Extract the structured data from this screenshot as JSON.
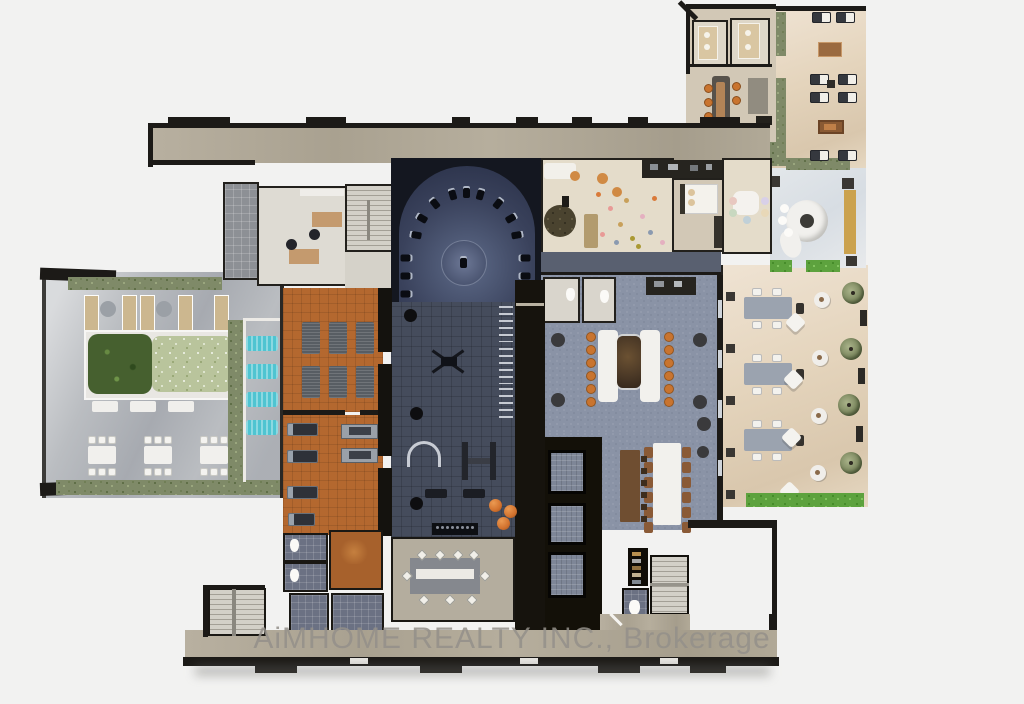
{
  "watermark": {
    "text": "AiMHOME REALTY INC., Brokerage"
  },
  "colors": {
    "bg": "#f2f2f1",
    "wall": "#1c1a17",
    "corridor": "#b1a997",
    "beige": "#e4dcca",
    "tan": "#d2c8b6",
    "office": "#dedbd3",
    "tile": "#8d9095",
    "tileBlue": "#6b7183",
    "navyDeep": "#141720",
    "navy": "#3d4660",
    "slate": "#454c5c",
    "terracotta": "#b4682f",
    "carpet": "#8a93a6",
    "carpetDark": "#596070",
    "elevator": "#7e8697",
    "concrete": "#babdc1",
    "hedge": "#7f8a68",
    "hedgeBright": "#5da23e",
    "teal": "#4fc4d1",
    "orange": "#c9742f",
    "wood": "#c49a6e",
    "white": "#f2f1ed",
    "steps": "#cfccc4",
    "warm": "#e7dbc9",
    "cool": "#dde2e7",
    "brown": "#8a5a36",
    "ball": "#d2722e",
    "watermark": "#94908a"
  }
}
